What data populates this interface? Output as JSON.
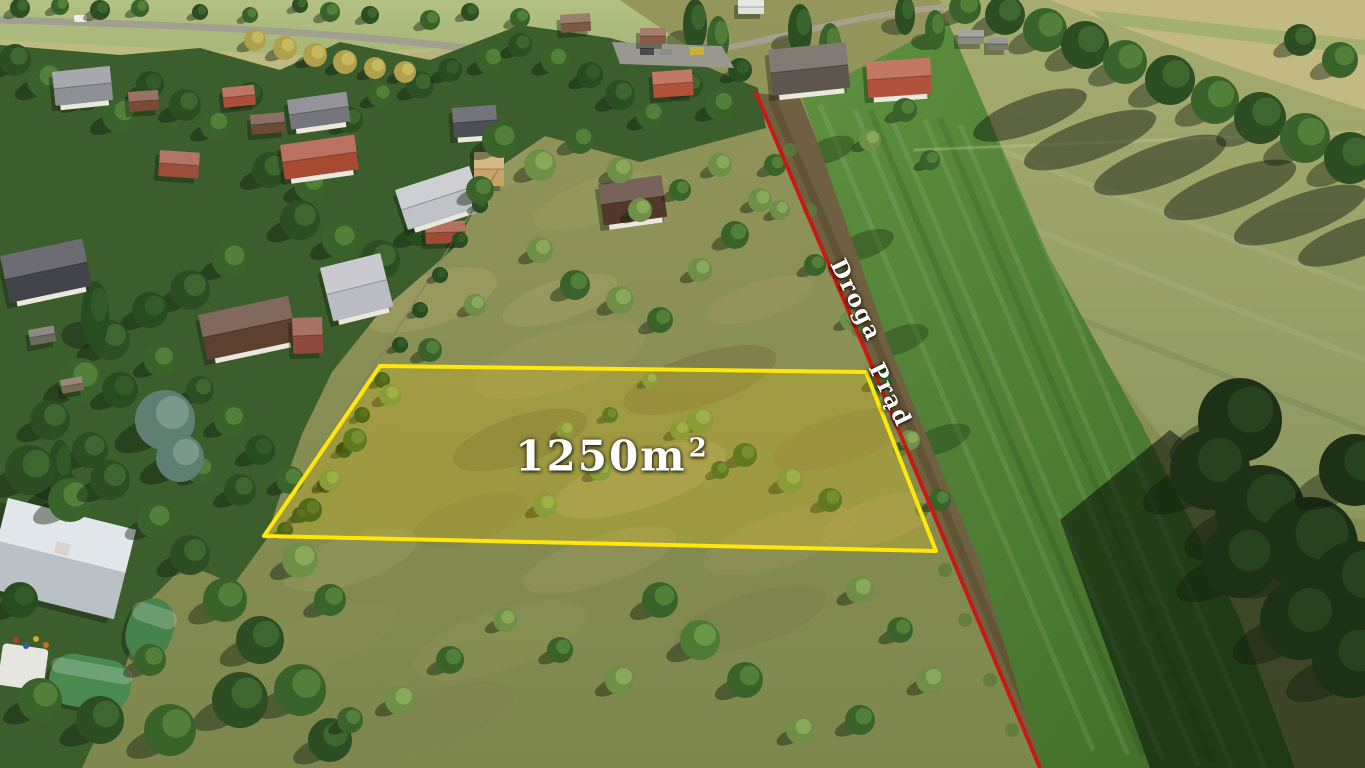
{
  "annotations": {
    "area_label": {
      "value": "1250m",
      "superscript": "2",
      "text_color": "#ffffff"
    },
    "plot_outline": {
      "points": "380,366 866,372 936,551 264,536",
      "stroke_color": "#ffe70a",
      "fill_color": "rgba(255,210,0,0.20)",
      "stroke_width": "4"
    },
    "boundary_line": {
      "points": "756,93 866,352 953,560 1040,768",
      "color": "#c81a14",
      "stroke_width": "4",
      "labels": [
        {
          "text": "Droga"
        },
        {
          "text": "Prąd"
        }
      ]
    }
  }
}
